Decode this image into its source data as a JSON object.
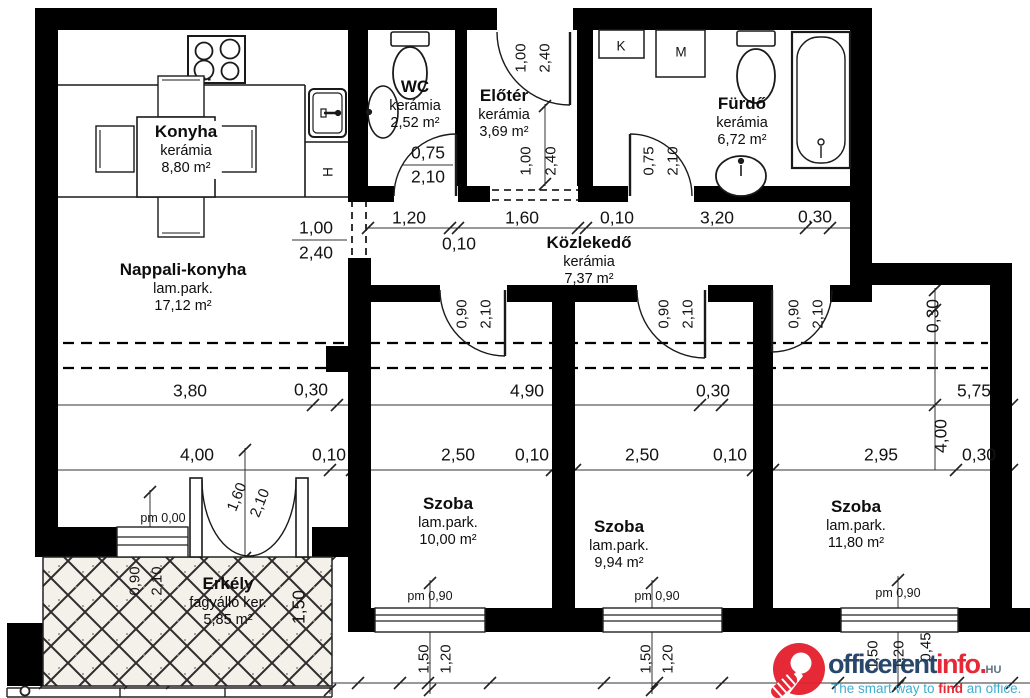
{
  "plan": {
    "rooms": [
      {
        "name": "Konyha",
        "finish": "kerámia",
        "area": "8,80 m²"
      },
      {
        "name": "WC",
        "finish": "kerámia",
        "area": "2,52 m²"
      },
      {
        "name": "Előtér",
        "finish": "kerámia",
        "area": "3,69 m²"
      },
      {
        "name": "Fürdő",
        "finish": "kerámia",
        "area": "6,72 m²"
      },
      {
        "name": "Nappali-konyha",
        "finish": "lam.park.",
        "area": "17,12 m²"
      },
      {
        "name": "Közlekedő",
        "finish": "kerámia",
        "area": "7,37 m²"
      },
      {
        "name": "Szoba",
        "finish": "lam.park.",
        "area": "10,00 m²"
      },
      {
        "name": "Szoba",
        "finish": "lam.park.",
        "area": "9,94 m²"
      },
      {
        "name": "Szoba",
        "finish": "lam.park.",
        "area": "11,80 m²"
      },
      {
        "name": "Erkély",
        "finish": "fagyálló ker.",
        "area": "5,85 m²"
      }
    ],
    "app": {
      "k": "K",
      "m": "M",
      "h": "H"
    },
    "dims": {
      "c0": "1,20",
      "c1": "0,10",
      "c2": "1,60",
      "c3": "0,10",
      "c4": "3,20",
      "c5": "0,30",
      "nap_w": "1,00",
      "nap_h": "2,40",
      "entry_w": "1,00",
      "entry_h": "2,40",
      "elo_w": "1,00",
      "elo_h": "2,40",
      "wc_w": "0,75",
      "wc_h": "2,10",
      "fur_w": "0,75",
      "fur_h": "2,10",
      "rd_w": "0,90",
      "rd_h": "2,10",
      "m0": "3,80",
      "m1": "0,30",
      "m2": "4,90",
      "m3": "0,30",
      "m4": "5,75",
      "l0": "4,00",
      "l1": "0,10",
      "l2": "2,50",
      "l3": "0,10",
      "l4": "2,50",
      "l5": "0,10",
      "l6": "2,95",
      "l7": "0,30",
      "rv0": "0,30",
      "rv1": "4,00",
      "bd_w": "1,60",
      "bd_h": "2,10",
      "bw_w": "0,90",
      "bw_h": "2,10",
      "bal_d": "1,50",
      "pm0": "pm 0,00",
      "pm90": "pm 0,90",
      "win_a": "1,50",
      "win_b": "1,20",
      "win_c": "0,45"
    }
  },
  "watermark": {
    "brand_a": "officerent",
    "brand_b": "info.",
    "tld": "HU",
    "tag_a": "The smart way to ",
    "tag_b": "find",
    "tag_c": " an office.",
    "colors": {
      "red": "#e41e2d",
      "navy": "#1d3e63",
      "teal": "#36a9cf",
      "wall": "#000000"
    }
  }
}
